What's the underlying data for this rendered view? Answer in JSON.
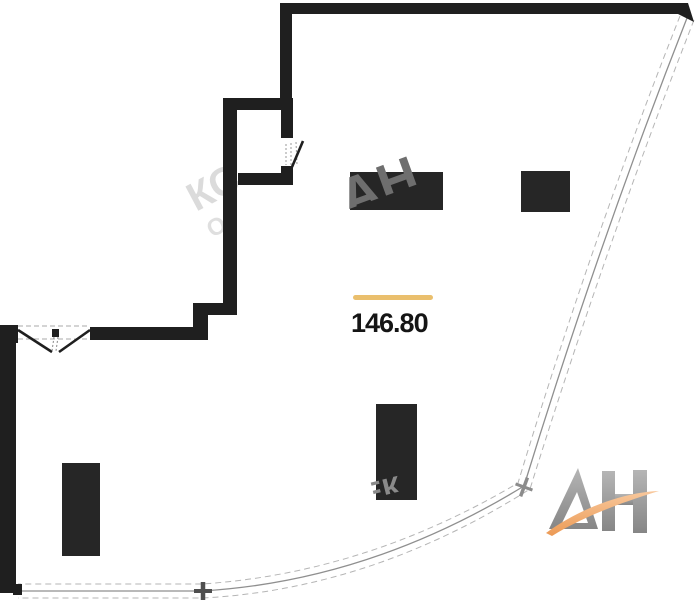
{
  "floor_plan": {
    "area_label": "146.80",
    "underline_color": "#eabf6d",
    "wall_color": "#1f1f1f",
    "furniture_color": "#262626",
    "glazing_line_color": "#8f8f8f"
  },
  "logo": {
    "text": "АН",
    "letter_color": "#9b9b9b",
    "swoosh_color": "#ee9d59"
  },
  "watermark": {
    "fragments": [
      "КС",
      "О",
      "АН",
      "ЕК"
    ]
  }
}
